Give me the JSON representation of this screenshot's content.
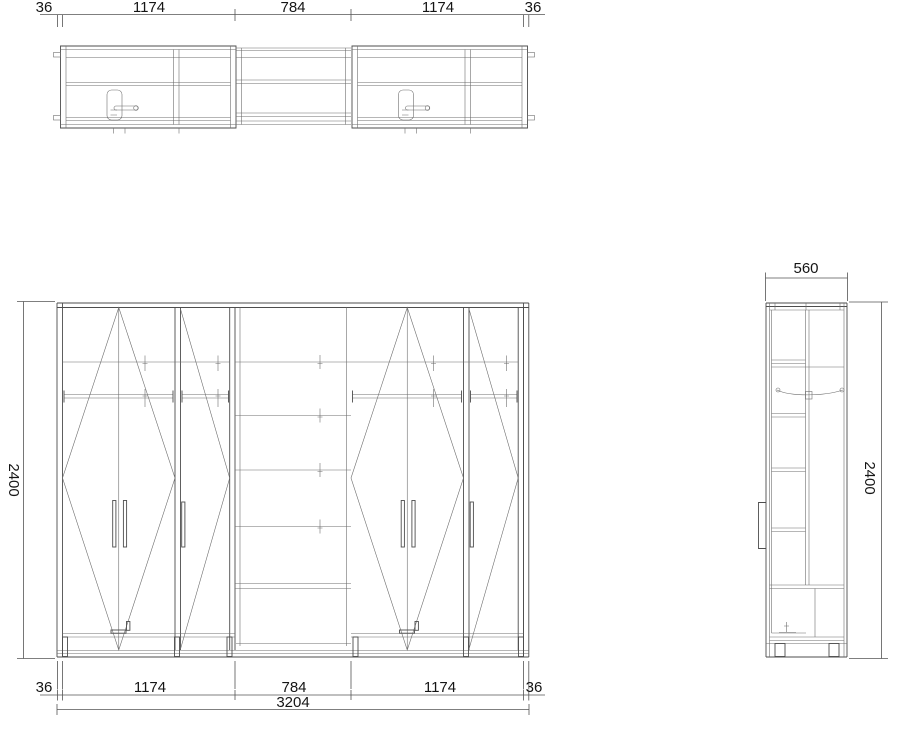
{
  "drawing": {
    "type": "furniture technical drawing - wardrobe, three orthographic views",
    "views": [
      "plan-view",
      "front-elevation",
      "side-elevation"
    ]
  },
  "dims": {
    "top": [
      "36",
      "1174",
      "784",
      "1174",
      "36"
    ],
    "bottom": [
      "36",
      "1174",
      "784",
      "1174",
      "36"
    ],
    "total": "3204",
    "height_left": "2400",
    "height_right": "2400",
    "depth": "560"
  },
  "colors": {
    "background": "#ffffff",
    "line": "#4d4d4d",
    "text": "#151515"
  }
}
